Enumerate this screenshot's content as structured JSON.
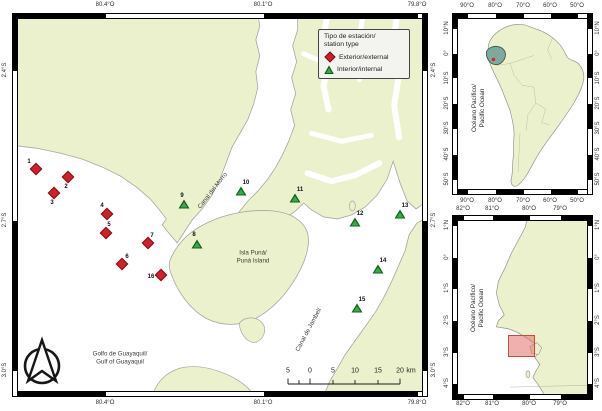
{
  "colors": {
    "land": "#ecf1cd",
    "ocean": "#ffffff",
    "external_marker": "#d21f2b",
    "internal_marker": "#3ba949",
    "ecuador_highlight": "#7cab9e",
    "study_area_box": "#e2635d"
  },
  "legend": {
    "title": [
      "Tipo de estación/",
      "station type"
    ],
    "items": [
      {
        "marker": "external",
        "label": "Exterior/external"
      },
      {
        "marker": "internal",
        "label": "Interior/internal"
      }
    ]
  },
  "place_labels": [
    {
      "name": "canal-del-morro",
      "lines": [
        "Canal del Morro"
      ],
      "x": 213,
      "y": 191,
      "rot": -52
    },
    {
      "name": "isla-puna",
      "lines": [
        "Isla Puná/",
        "Puná Island"
      ],
      "x": 253,
      "y": 257,
      "rot": 0
    },
    {
      "name": "canal-de-jambeli",
      "lines": [
        "Canal de Jambelí"
      ],
      "x": 309,
      "y": 330,
      "rot": -62
    },
    {
      "name": "golfo-de-guayaquil",
      "lines": [
        "Golfo de Guayaquil/",
        "Gulf of Guayaquil"
      ],
      "x": 120,
      "y": 358,
      "rot": 0
    }
  ],
  "ocean_labels": [
    {
      "name": "pacific-ocean-sa",
      "lines": [
        "Océano Pacífico/",
        "Pacific Ocean"
      ],
      "x": 479,
      "y": 108
    },
    {
      "name": "pacific-ocean-ec",
      "lines": [
        "Océano Pacífico/",
        "Pacific Ocean"
      ],
      "x": 478,
      "y": 308
    }
  ],
  "stations": [
    {
      "id": "1",
      "type": "external",
      "x": 36,
      "y": 169,
      "lx": 29,
      "ly": 162
    },
    {
      "id": "2",
      "type": "external",
      "x": 68,
      "y": 177,
      "lx": 66,
      "ly": 187
    },
    {
      "id": "3",
      "type": "external",
      "x": 54,
      "y": 193,
      "lx": 52,
      "ly": 203
    },
    {
      "id": "4",
      "type": "external",
      "x": 107,
      "y": 214,
      "lx": 102,
      "ly": 206
    },
    {
      "id": "5",
      "type": "external",
      "x": 106,
      "y": 233,
      "lx": 109,
      "ly": 225
    },
    {
      "id": "6",
      "type": "external",
      "x": 122,
      "y": 264,
      "lx": 127,
      "ly": 257
    },
    {
      "id": "7",
      "type": "external",
      "x": 148,
      "y": 243,
      "lx": 152,
      "ly": 236
    },
    {
      "id": "16",
      "type": "external",
      "x": 161,
      "y": 275,
      "lx": 151,
      "ly": 277
    },
    {
      "id": "8",
      "type": "internal",
      "x": 197,
      "y": 244,
      "lx": 194,
      "ly": 235
    },
    {
      "id": "9",
      "type": "internal",
      "x": 184,
      "y": 204,
      "lx": 182,
      "ly": 196
    },
    {
      "id": "10",
      "type": "internal",
      "x": 241,
      "y": 191,
      "lx": 246,
      "ly": 183
    },
    {
      "id": "11",
      "type": "internal",
      "x": 295,
      "y": 198,
      "lx": 300,
      "ly": 190
    },
    {
      "id": "12",
      "type": "internal",
      "x": 355,
      "y": 222,
      "lx": 360,
      "ly": 214
    },
    {
      "id": "13",
      "type": "internal",
      "x": 400,
      "y": 214,
      "lx": 405,
      "ly": 206
    },
    {
      "id": "14",
      "type": "internal",
      "x": 378,
      "y": 269,
      "lx": 383,
      "ly": 261
    },
    {
      "id": "15",
      "type": "internal",
      "x": 357,
      "y": 308,
      "lx": 362,
      "ly": 300
    }
  ],
  "axis_labels": [
    {
      "group": "main-top",
      "rot": 0,
      "items": [
        [
          "80.4°O",
          105,
          5
        ],
        [
          "80.1°O",
          263,
          5
        ],
        [
          "79.8°O",
          417,
          5
        ]
      ]
    },
    {
      "group": "main-bottom",
      "rot": 0,
      "items": [
        [
          "80.4°O",
          105,
          403
        ],
        [
          "80.1°O",
          263,
          403
        ],
        [
          "79.8°O",
          417,
          403
        ]
      ]
    },
    {
      "group": "main-left",
      "rot": -90,
      "items": [
        [
          "2.4°S",
          5,
          70
        ],
        [
          "2.7°S",
          5,
          220
        ],
        [
          "3.0°S",
          5,
          370
        ]
      ]
    },
    {
      "group": "main-right",
      "rot": -90,
      "items": [
        [
          "2.4°S",
          434,
          70
        ],
        [
          "2.7°S",
          434,
          220
        ],
        [
          "3.0°S",
          434,
          370
        ]
      ]
    },
    {
      "group": "sa-top",
      "rot": 0,
      "items": [
        [
          "90°O",
          467,
          6
        ],
        [
          "80°O",
          495,
          6
        ],
        [
          "70°O",
          523,
          6
        ],
        [
          "60°O",
          550,
          6
        ],
        [
          "50°O",
          577,
          6
        ]
      ]
    },
    {
      "group": "sa-bottom",
      "rot": 0,
      "items": [
        [
          "90°O",
          467,
          201
        ],
        [
          "80°O",
          495,
          201
        ],
        [
          "70°O",
          523,
          201
        ],
        [
          "60°O",
          550,
          201
        ],
        [
          "50°O",
          577,
          201
        ]
      ]
    },
    {
      "group": "sa-left",
      "rot": -90,
      "items": [
        [
          "10°N",
          447,
          28
        ],
        [
          "0°",
          447,
          53
        ],
        [
          "10°S",
          447,
          78
        ],
        [
          "20°S",
          447,
          103
        ],
        [
          "30°S",
          447,
          128
        ],
        [
          "40°S",
          447,
          154
        ],
        [
          "50°S",
          447,
          179
        ]
      ]
    },
    {
      "group": "sa-right",
      "rot": -90,
      "items": [
        [
          "10°N",
          598,
          28
        ],
        [
          "0°",
          598,
          53
        ],
        [
          "10°S",
          598,
          78
        ],
        [
          "20°S",
          598,
          103
        ],
        [
          "30°S",
          598,
          128
        ],
        [
          "40°S",
          598,
          154
        ],
        [
          "50°S",
          598,
          179
        ]
      ]
    },
    {
      "group": "ec-top",
      "rot": 0,
      "items": [
        [
          "82°O",
          463,
          209
        ],
        [
          "81°O",
          492,
          209
        ],
        [
          "80°O",
          529,
          209
        ],
        [
          "79°O",
          560,
          209
        ]
      ]
    },
    {
      "group": "ec-bottom",
      "rot": 0,
      "items": [
        [
          "82°O",
          463,
          404
        ],
        [
          "81°O",
          492,
          404
        ],
        [
          "80°O",
          529,
          404
        ],
        [
          "79°O",
          560,
          404
        ]
      ]
    },
    {
      "group": "ec-left",
      "rot": -90,
      "items": [
        [
          "1°N",
          447,
          225
        ],
        [
          "0°",
          447,
          257
        ],
        [
          "1°S",
          447,
          288
        ],
        [
          "2°S",
          447,
          320
        ],
        [
          "3°S",
          447,
          352
        ],
        [
          "4°S",
          447,
          383
        ]
      ]
    },
    {
      "group": "ec-right",
      "rot": -90,
      "items": [
        [
          "1°N",
          598,
          225
        ],
        [
          "0°",
          598,
          257
        ],
        [
          "1°S",
          598,
          288
        ],
        [
          "2°S",
          598,
          320
        ],
        [
          "3°S",
          598,
          352
        ],
        [
          "4°S",
          598,
          383
        ]
      ]
    }
  ],
  "scalebar": {
    "y": 371,
    "numbers": [
      [
        "5",
        288
      ],
      [
        "0",
        310
      ],
      [
        "5",
        333
      ],
      [
        "10",
        355
      ],
      [
        "15",
        378
      ],
      [
        "20",
        400
      ],
      [
        "km",
        411
      ]
    ]
  }
}
